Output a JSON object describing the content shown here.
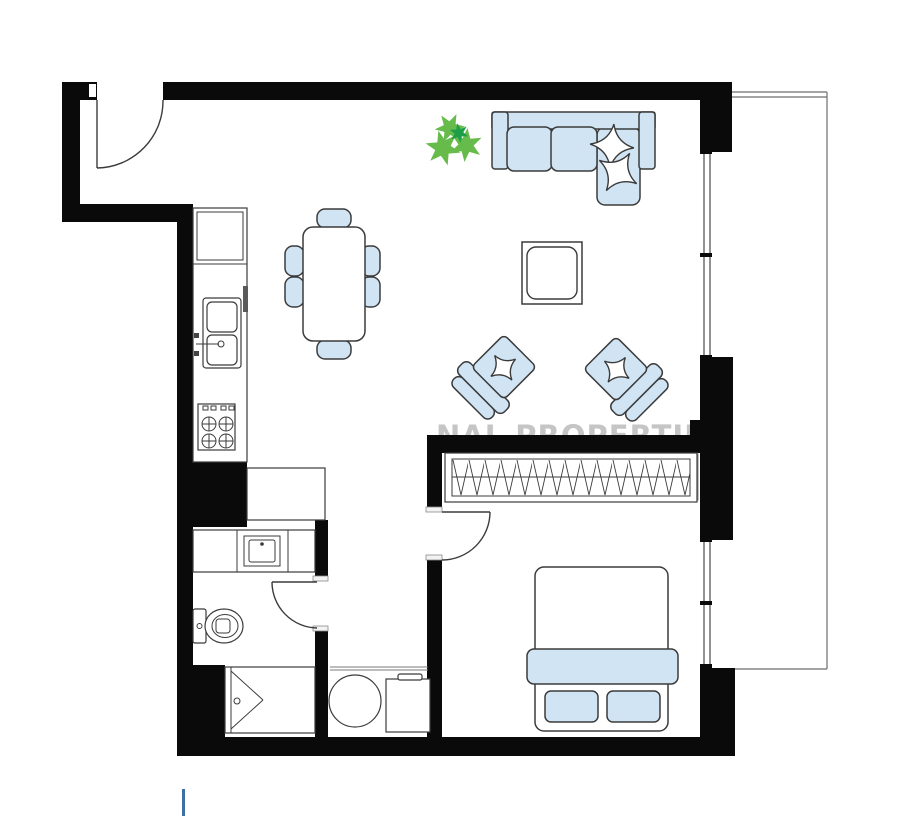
{
  "title": "apartment-floor-plan",
  "watermark": {
    "text": "NAL PROPERTIES"
  },
  "palette": {
    "wall": "#0a0a0a",
    "line": "#3b3b3b",
    "blue": "#d0e4f3",
    "white": "#ffffff",
    "gray": "#6e6e6e",
    "wm": "#c5c5c5",
    "green1": "#66bb4a",
    "green2": "#1f9e48",
    "accent": "#3e6fa6"
  },
  "furniture": [
    "entrance-door",
    "living-window",
    "bedroom-window",
    "balcony",
    "kitchen-counter",
    "kitchen-sink",
    "stove",
    "dining-table",
    "dining-chairs",
    "plant",
    "corner-sofa",
    "sofa-pillows",
    "coffee-table",
    "armchair-left",
    "armchair-right",
    "wardrobe",
    "double-bed",
    "bed-pillows",
    "bathroom-vanity",
    "vanity-sink",
    "toilet",
    "shower",
    "washing-machine",
    "laundry-unit"
  ]
}
